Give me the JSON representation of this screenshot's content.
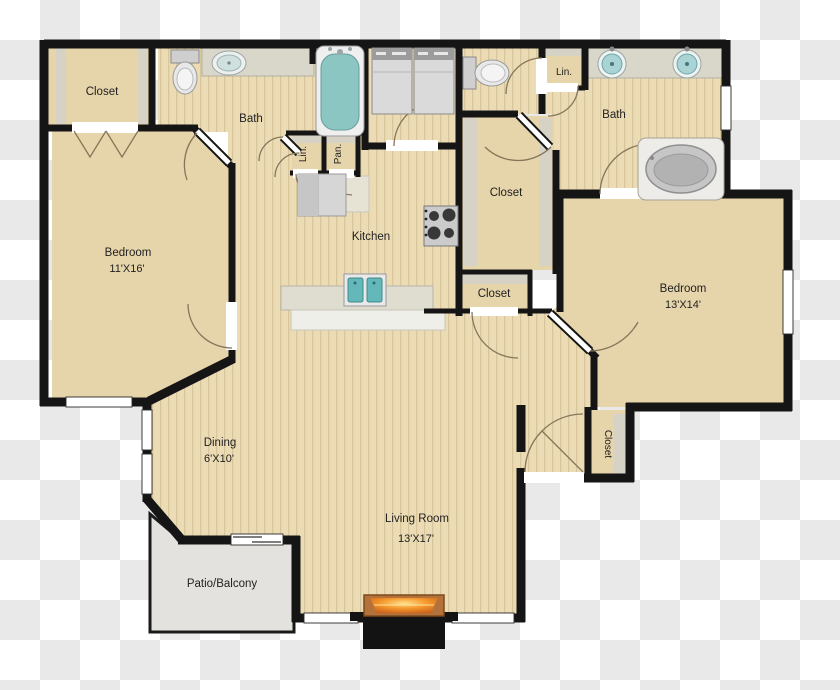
{
  "plan": {
    "type": "apartment-floor-plan",
    "background": "transparency-checkerboard"
  },
  "rooms": {
    "closet_top_left": {
      "label": "Closet"
    },
    "bath_left": {
      "label": "Bath"
    },
    "linen_hall": {
      "label": "Lin."
    },
    "pantry": {
      "label": "Pan."
    },
    "kitchen": {
      "label": "Kitchen"
    },
    "bedroom_left": {
      "label": "Bedroom",
      "dimensions": "11'X16'"
    },
    "walk_in_closet": {
      "label": "Closet"
    },
    "hall_closet": {
      "label": "Closet"
    },
    "linen_top_right": {
      "label": "Lin."
    },
    "bath_right": {
      "label": "Bath"
    },
    "bedroom_right": {
      "label": "Bedroom",
      "dimensions": "13'X14'"
    },
    "dining": {
      "label": "Dining",
      "dimensions": "6'X10'"
    },
    "entry_closet": {
      "label": "Closet"
    },
    "living_room": {
      "label": "Living Room",
      "dimensions": "13'X17'"
    },
    "patio": {
      "label": "Patio/Balcony"
    }
  },
  "fixtures": {
    "bath_left": [
      "toilet",
      "vanity-sink",
      "bathtub"
    ],
    "laundry": [
      "washer",
      "dryer"
    ],
    "water_closet": [
      "toilet"
    ],
    "bath_right": [
      "double-vanity-sinks",
      "garden-tub"
    ],
    "kitchen": [
      "refrigerator",
      "stove",
      "double-sink-island"
    ],
    "living_room": [
      "fireplace"
    ]
  },
  "colors": {
    "wall": "#151515",
    "carpet": "#e6d4aa",
    "wood_floor": "#ecdcb6",
    "counter": "#d9d7c9",
    "shelf": "#d7d2c6",
    "patio_floor": "#e3e2df",
    "fixture_teal": "#8cc6c2",
    "fire_orange": "#e07f1f"
  }
}
